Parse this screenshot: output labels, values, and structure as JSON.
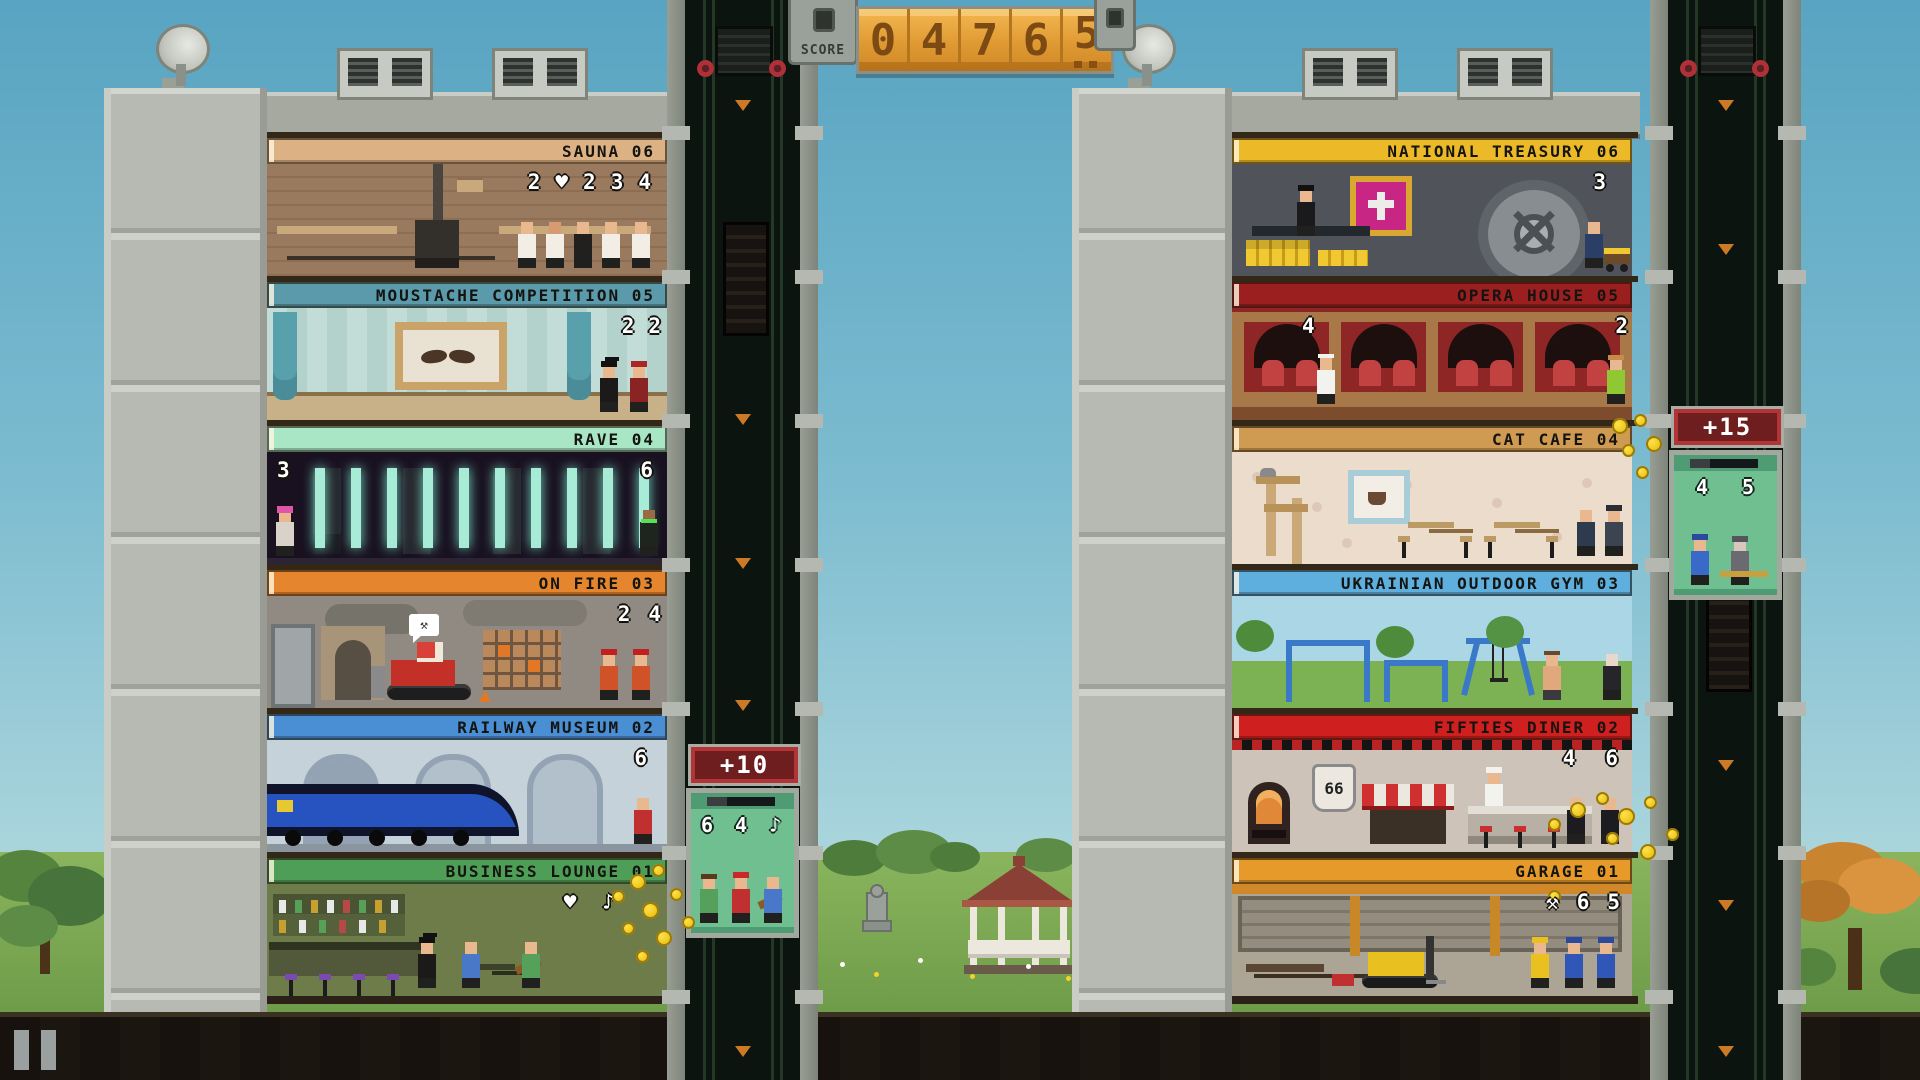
{
  "hud": {
    "score_label": "SCORE",
    "score_digits": [
      "0",
      "4",
      "7",
      "6",
      "5"
    ],
    "colors": {
      "score_display": "#e8a33d",
      "score_digit": "#7c4a12",
      "bonus_banner": "#6e1e1e",
      "indicator_text": "#ffffff"
    }
  },
  "left_tower": {
    "floors": [
      {
        "label": "SAUNA 06",
        "accent": "#dcb183",
        "indicators": [
          "2",
          "♥",
          "2",
          "3",
          "4"
        ],
        "indicators_left": []
      },
      {
        "label": "MOUSTACHE COMPETITION 05",
        "accent": "#5b9aab",
        "indicators": [
          "2",
          "2"
        ],
        "indicators_left": []
      },
      {
        "label": "RAVE 04",
        "accent": "#a9e6c6",
        "indicators": [
          "6"
        ],
        "indicators_left": [
          "3"
        ]
      },
      {
        "label": "ON FIRE 03",
        "accent": "#e5862e",
        "indicators": [
          "2",
          "4"
        ],
        "indicators_left": [],
        "bubble": "⚒"
      },
      {
        "label": "RAILWAY MUSEUM 02",
        "accent": "#4a8ed3",
        "indicators": [
          "6"
        ],
        "indicators_left": []
      },
      {
        "label": "BUSINESS LOUNGE 01",
        "accent": "#4f9e57",
        "indicators": [
          "♥",
          "♪"
        ],
        "indicators_left": []
      }
    ],
    "elevator": {
      "bonus": "+10",
      "passenger_labels": [
        "6",
        "4",
        "♪"
      ]
    }
  },
  "right_tower": {
    "floors": [
      {
        "label": "NATIONAL TREASURY 06",
        "accent": "#ecba29",
        "indicators": [
          "3"
        ],
        "indicators_left": []
      },
      {
        "label": "OPERA HOUSE 05",
        "accent": "#9c1f1f",
        "indicators": [
          "2"
        ],
        "indicators_left": [
          "4"
        ]
      },
      {
        "label": "CAT CAFE 04",
        "accent": "#cf9a52",
        "indicators": [],
        "indicators_left": []
      },
      {
        "label": "UKRAINIAN OUTDOOR GYM 03",
        "accent": "#5eaede",
        "indicators": [],
        "indicators_left": []
      },
      {
        "label": "FIFTIES DINER 02",
        "accent": "#d01f1f",
        "indicators": [
          "4",
          "6"
        ],
        "indicators_left": []
      },
      {
        "label": "GARAGE 01",
        "accent": "#e59a2a",
        "indicators": [
          "⚒",
          "6",
          "5"
        ],
        "indicators_left": []
      }
    ],
    "elevator": {
      "bonus": "+15",
      "passenger_labels": [
        "4",
        "5"
      ]
    },
    "diner_sign": "66"
  }
}
